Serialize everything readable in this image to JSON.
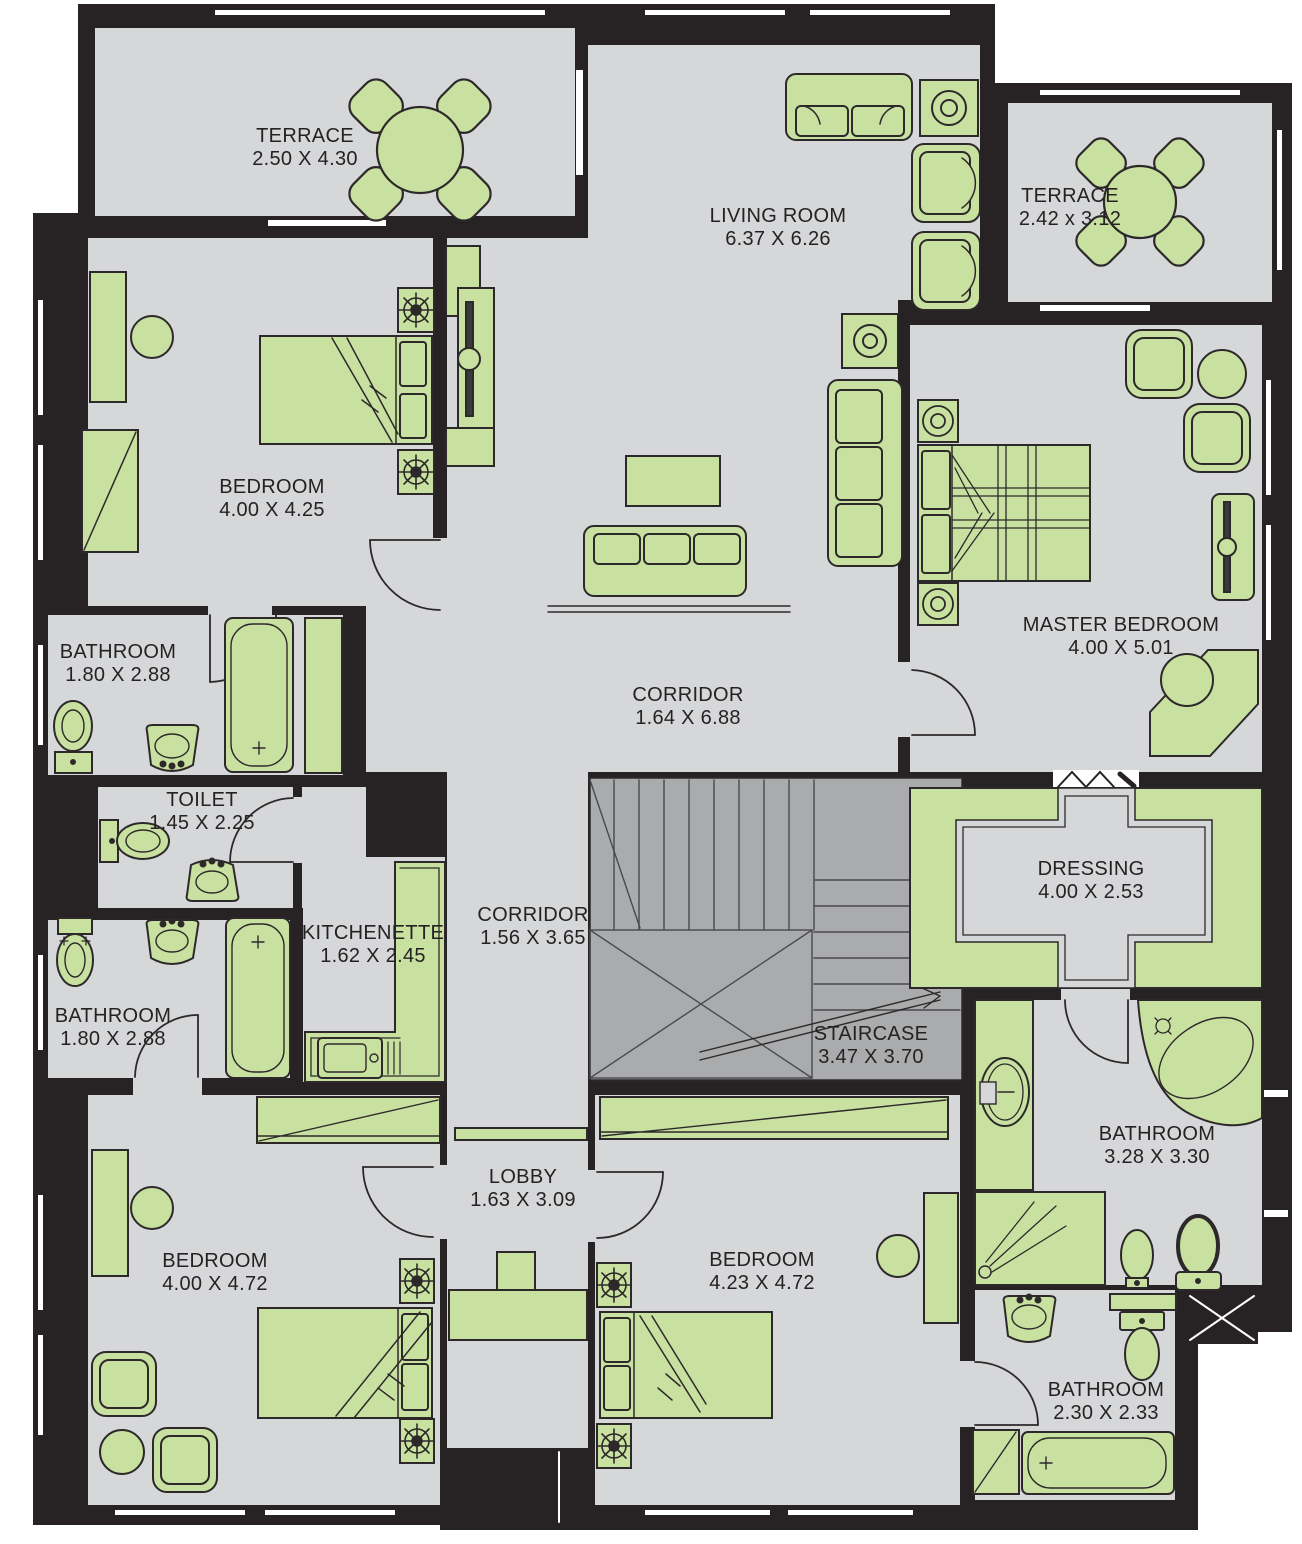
{
  "title": "Apartment Floor Plan",
  "colors": {
    "wall": "#272224",
    "floor": "#d6d7d9",
    "furniture_green": "#c9e1a0",
    "stair_gray": "#a9abac",
    "outline": "#2d292a",
    "background": "#ffffff",
    "label_text": "#262122"
  },
  "rooms": [
    {
      "id": "terrace-top-left",
      "name": "TERRACE",
      "dims": "2.50 X 4.30"
    },
    {
      "id": "living-room",
      "name": "LIVING ROOM",
      "dims": "6.37 X 6.26"
    },
    {
      "id": "terrace-top-right",
      "name": "TERRACE",
      "dims": "2.42 x 3.12"
    },
    {
      "id": "bedroom-top-left",
      "name": "BEDROOM",
      "dims": "4.00 X 4.25"
    },
    {
      "id": "master-bedroom",
      "name": "MASTER BEDROOM",
      "dims": "4.00 X 5.01"
    },
    {
      "id": "bathroom-1",
      "name": "BATHROOM",
      "dims": "1.80 X 2.88"
    },
    {
      "id": "corridor-main",
      "name": "CORRIDOR",
      "dims": "1.64 X 6.88"
    },
    {
      "id": "toilet",
      "name": "TOILET",
      "dims": "1.45 X 2.25"
    },
    {
      "id": "dressing",
      "name": "DRESSING",
      "dims": "4.00 X 2.53"
    },
    {
      "id": "kitchenette",
      "name": "KITCHENETTE",
      "dims": "1.62 X 2.45"
    },
    {
      "id": "corridor-2",
      "name": "CORRIDOR",
      "dims": "1.56 X 3.65"
    },
    {
      "id": "bathroom-2",
      "name": "BATHROOM",
      "dims": "1.80 X 2.88"
    },
    {
      "id": "staircase",
      "name": "STAIRCASE",
      "dims": "3.47 X 3.70"
    },
    {
      "id": "bathroom-3",
      "name": "BATHROOM",
      "dims": "3.28 X 3.30"
    },
    {
      "id": "lobby",
      "name": "LOBBY",
      "dims": "1.63 X 3.09"
    },
    {
      "id": "bedroom-2",
      "name": "BEDROOM",
      "dims": "4.00 X 4.72"
    },
    {
      "id": "bedroom-3",
      "name": "BEDROOM",
      "dims": "4.23 X 4.72"
    },
    {
      "id": "bathroom-4",
      "name": "BATHROOM",
      "dims": "2.30 X 2.33"
    }
  ],
  "icons": [
    "round-dining-table-icon",
    "terrace-chair-icon",
    "sofa-icon",
    "armchair-icon",
    "lamp-table-icon",
    "tv-unit-icon",
    "coffee-table-icon",
    "rug-icon",
    "double-bed-icon",
    "single-bed-icon",
    "nightstand-icon",
    "ceiling-lamp-icon",
    "desk-icon",
    "desk-chair-icon",
    "wardrobe-icon",
    "dressing-cabinet-icon",
    "toilet-icon",
    "bidet-icon",
    "washbasin-icon",
    "bathtub-icon",
    "corner-bathtub-icon",
    "shower-icon",
    "vanity-icon",
    "kitchen-counter-icon",
    "kitchen-sink-icon",
    "staircase-icon",
    "door-arc-icon",
    "window-icon",
    "shaft-x-icon",
    "hanger-icon",
    "doormat-icon"
  ]
}
